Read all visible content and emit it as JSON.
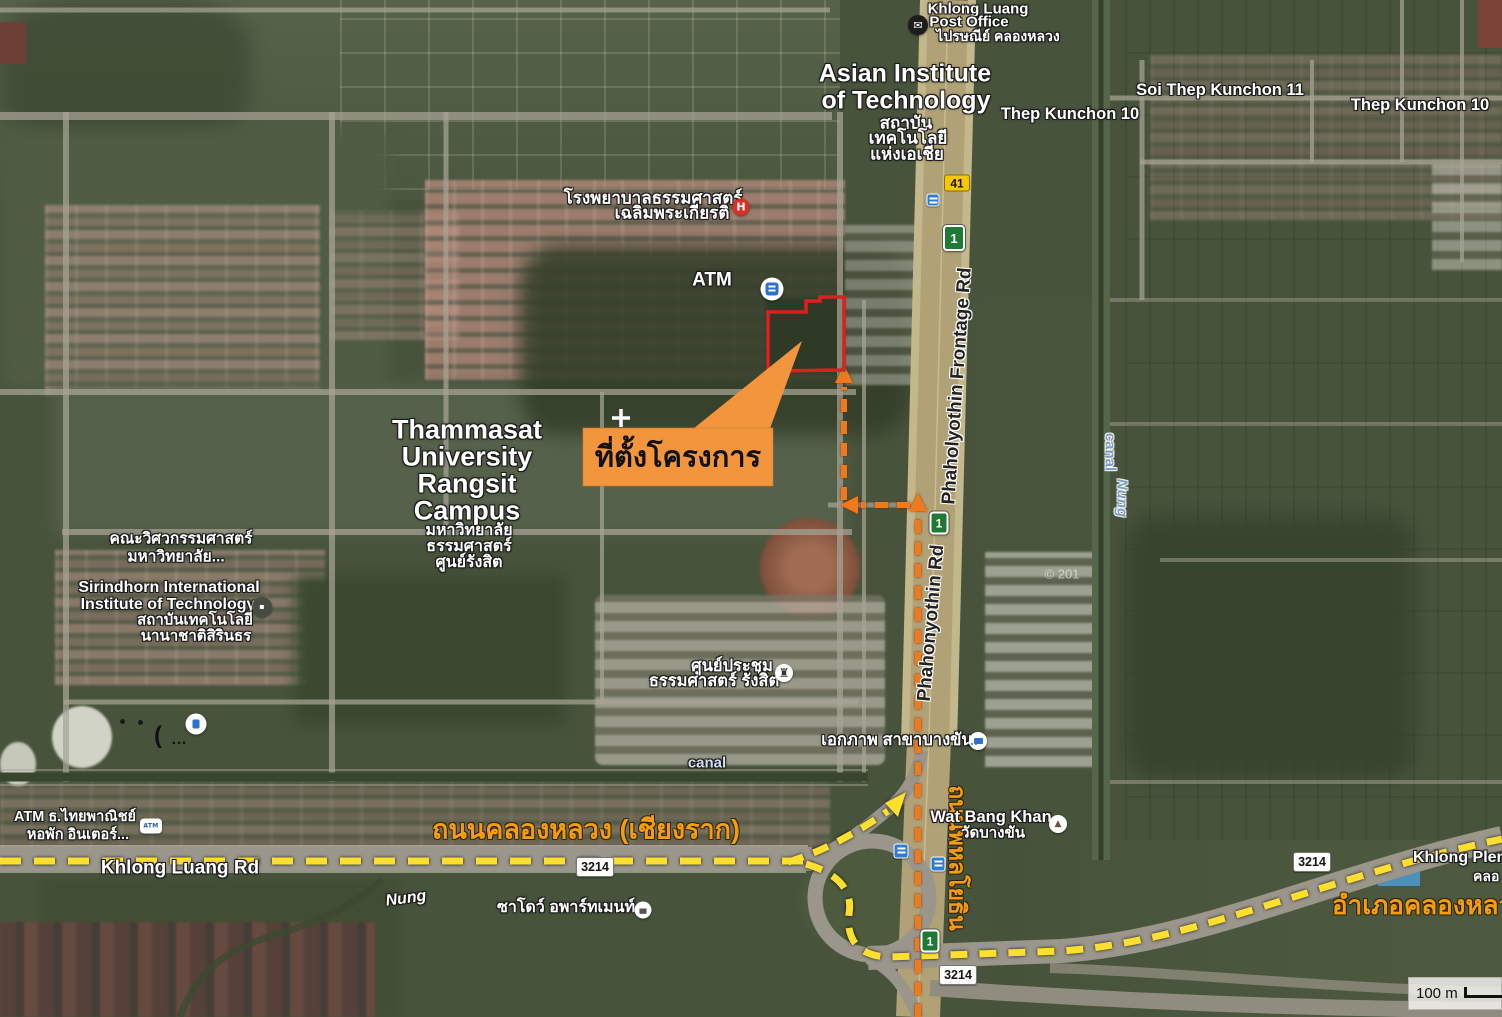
{
  "labels": {
    "post_office": {
      "line1": "Khlong Luang",
      "line2": "Post Office",
      "thai": "ไปรษณีย์ คลองหลวง"
    },
    "ait": {
      "line1": "Asian Institute",
      "line2": "of Technology",
      "thai1": "สถาบัน",
      "thai2": "เทคโนโลยี",
      "thai3": "แห่งเอเชีย"
    },
    "thep_kunchon_10_west": "Thep Kunchon 10",
    "soi_thep_kunchon_11": "Soi Thep Kunchon 11",
    "thep_kunchon_10_east": "Thep Kunchon 10",
    "hospital": {
      "line1": "โรงพยาบาลธรรมศาสตร์",
      "line2": "เฉลิมพระเกียรติ"
    },
    "atm": "ATM",
    "thammasat": {
      "line1": "Thammasat",
      "line2": "University",
      "line3": "Rangsit",
      "line4": "Campus",
      "thai1": "มหาวิทยาลัย",
      "thai2": "ธรรมศาสตร์",
      "thai3": "ศูนย์รังสิต"
    },
    "engineering": {
      "line1": "คณะวิศวกรรมศาสตร์",
      "line2": "มหาวิทยาลัย..."
    },
    "siit": {
      "line1": "Sirindhorn International",
      "line2": "Institute of Technology",
      "thai1": "สถาบันเทคโนโลยี",
      "thai2": "นานาชาติสิรินธร"
    },
    "site_callout": "ที่ตั้งโครงการ",
    "convention": {
      "line1": "ศูนย์ประชุม",
      "line2": "ธรรมศาสตร์ รังสิต"
    },
    "ekkaphap_branch": "เอกภาพ สาขาบางขัน",
    "canal_west": "canal",
    "canal_nung": {
      "line1": "canal",
      "line2": "Nung"
    },
    "phaholyothin_frontage_rd": "Phaholyothin Frontage Rd",
    "phahonyothin_rd": "Phahonyothin Rd",
    "phahonyothin_thai": "ถนนพหลโยธิน",
    "khlong_luang_thai": "ถนนคลองหลวง (เชียงราก)",
    "khlong_luang_rd": "Khlong Luang Rd",
    "nung": "Nung",
    "shadow_apartment": "ซาโดว์ อพาร์ทเมนท์",
    "wat_bang_khan": {
      "line1": "Wat Bang Khan",
      "line2": "วัดบางขัน"
    },
    "khlong_plen": {
      "line1": "Khlong Plen",
      "line2": "คลอ"
    },
    "amphoe_khlong_luang": "อำเภอคลองหลวง",
    "atm_scb": {
      "line1": "ATM ธ.ไทยพาณิชย์",
      "line2": "หอพัก อินเตอร์..."
    },
    "copyright": "© 201"
  },
  "shields": {
    "route_41": "41",
    "highway_1": "1",
    "route_3214": "3214"
  },
  "icons": {
    "post_office_glyph": "✉",
    "hospital_glyph": "H",
    "atm_scb_text": "ATM",
    "temple_glyph": "▲",
    "lodging_glyph": "▄",
    "siit_glyph": "▪",
    "convention_glyph": "♜",
    "artifact_paren": "(",
    "artifact_dots": "…"
  },
  "scale_bar": {
    "label": "100 m"
  },
  "colors": {
    "site_outline": "#dd1f1f",
    "callout_bg": "#f2953c",
    "route_arrow_orange": "#f0791c",
    "route_dash_yellow": "#ffdf2e",
    "road_label_orange": "#f59d0c",
    "shield_41_bg": "#f7c800",
    "shield_highway_green": "#1f7a33",
    "canal_label_blue": "#7d9cc8"
  }
}
